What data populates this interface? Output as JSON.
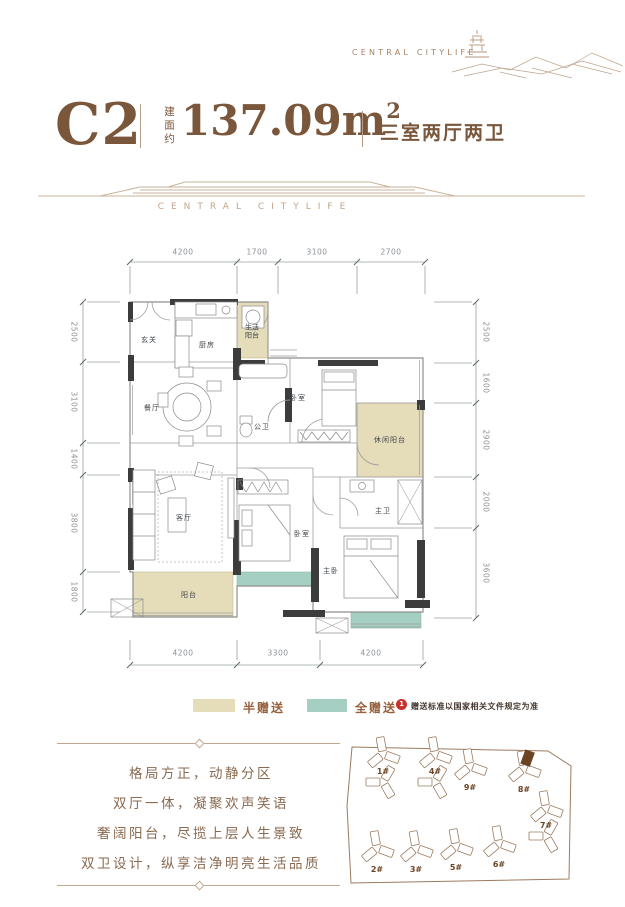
{
  "logo": {
    "brand": "CENTRAL CITYLIFE"
  },
  "header": {
    "unit": "C2",
    "area_label": "建面约",
    "area_value": "137.09m",
    "area_sup": "2",
    "layout": "三室两厅两卫"
  },
  "divider": {
    "brand": "CENTRAL CITYLIFE"
  },
  "floorplan": {
    "dims_top": [
      "4200",
      "1700",
      "3100",
      "2700"
    ],
    "dims_bottom": [
      "4200",
      "3300",
      "4200"
    ],
    "dims_left": [
      "2500",
      "3100",
      "1400",
      "3800",
      "1800"
    ],
    "dims_right": [
      "2500",
      "1600",
      "2900",
      "2000",
      "3600"
    ],
    "rooms": {
      "entry": "玄关",
      "kitchen": "厨房",
      "life_balcony": "生活阳台",
      "dining": "餐厅",
      "guest_bath": "公卫",
      "bedroom2": "卧室",
      "leisure_balcony": "休闲阳台",
      "living": "客厅",
      "balcony": "阳台",
      "bedroom3": "卧室",
      "master_bath": "主卫",
      "master_bedroom": "主卧"
    }
  },
  "legend": {
    "half_label": "半赠送",
    "full_label": "全赠送",
    "half_color": "#e5dcba",
    "full_color": "#a5cfc3",
    "badge": "1",
    "note": "赠送标准以国家相关文件规定为准"
  },
  "features": [
    "格局方正，动静分区",
    "双厅一体，凝聚欢声笑语",
    "奢阔阳台，尽揽上层人生景致",
    "双卫设计，纵享洁净明亮生活品质"
  ],
  "siteplan": {
    "highlight": "8#",
    "buildings": [
      {
        "label": "1#",
        "x": 383,
        "y": 768,
        "tall": true
      },
      {
        "label": "4#",
        "x": 435,
        "y": 768,
        "tall": true
      },
      {
        "label": "9#",
        "x": 470,
        "y": 766
      },
      {
        "label": "8#",
        "x": 524,
        "y": 768,
        "highlight": true
      },
      {
        "label": "2#",
        "x": 377,
        "y": 848
      },
      {
        "label": "3#",
        "x": 416,
        "y": 848
      },
      {
        "label": "5#",
        "x": 456,
        "y": 846
      },
      {
        "label": "6#",
        "x": 499,
        "y": 843
      },
      {
        "label": "7#",
        "x": 546,
        "y": 822,
        "tall": true
      }
    ]
  }
}
